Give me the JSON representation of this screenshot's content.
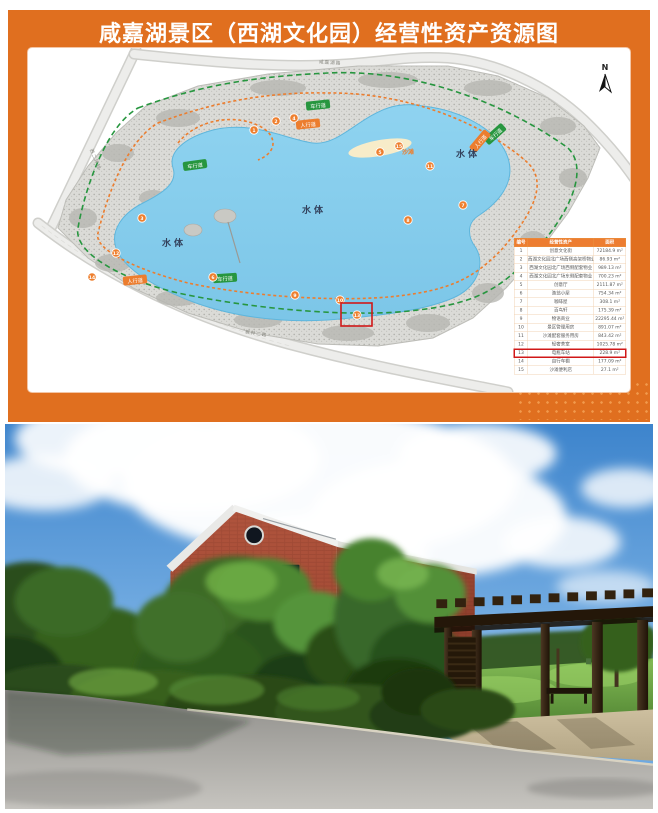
{
  "poster": {
    "title": "咸嘉湖景区（西湖文化园）经营性资产资源图",
    "map": {
      "north_label": "N",
      "water_label": "水体",
      "beach_label": "沙滩",
      "vehicle_path_label": "车行道",
      "pedestrian_path_label": "人行道",
      "roads": [
        {
          "name": "咸嘉湖路"
        },
        {
          "name": "西二环线"
        },
        {
          "name": "枫林二路"
        }
      ],
      "markers": [
        {
          "n": "1",
          "x": 226,
          "y": 82
        },
        {
          "n": "2",
          "x": 248,
          "y": 73
        },
        {
          "n": "3",
          "x": 114,
          "y": 170
        },
        {
          "n": "4",
          "x": 266,
          "y": 70
        },
        {
          "n": "5",
          "x": 352,
          "y": 104
        },
        {
          "n": "6",
          "x": 185,
          "y": 229
        },
        {
          "n": "7",
          "x": 435,
          "y": 157
        },
        {
          "n": "8",
          "x": 380,
          "y": 172
        },
        {
          "n": "9",
          "x": 267,
          "y": 247
        },
        {
          "n": "10",
          "x": 312,
          "y": 252
        },
        {
          "n": "11",
          "x": 402,
          "y": 118
        },
        {
          "n": "12",
          "x": 88,
          "y": 205
        },
        {
          "n": "13",
          "x": 329,
          "y": 267
        },
        {
          "n": "14",
          "x": 64,
          "y": 229
        },
        {
          "n": "15",
          "x": 371,
          "y": 98
        }
      ]
    },
    "table": {
      "headers": [
        "编号",
        "经营性资产",
        "面积"
      ],
      "rows": [
        [
          "1",
          "创意文化街",
          "72184.9 m²"
        ],
        [
          "2",
          "西湖文化园北广场西侧高架桥物业",
          "86.93 m²"
        ],
        [
          "3",
          "西湖文化园北广场西侧配套物业",
          "989.13 m²"
        ],
        [
          "4",
          "西湖文化园北广场东侧配套物业",
          "700.23 m²"
        ],
        [
          "5",
          "创意厅",
          "2111.87 m²"
        ],
        [
          "6",
          "渔翁小屋",
          "754.34 m²"
        ],
        [
          "7",
          "咖啡屋",
          "308.1 m²"
        ],
        [
          "8",
          "百鸟轩",
          "175.39 m²"
        ],
        [
          "9",
          "物语商业",
          "22295.44 m²"
        ],
        [
          "10",
          "景区管理用房",
          "891.07 m²"
        ],
        [
          "11",
          "沙滩配套服务用房",
          "843.42 m²"
        ],
        [
          "12",
          "轻奢茶室",
          "1025.78 m²"
        ],
        [
          "13",
          "电瓶车站",
          "228.9 m²"
        ],
        [
          "14",
          "自行车棚",
          "177.09 m²"
        ],
        [
          "15",
          "沙滩便利店",
          "27.1 m²"
        ]
      ],
      "highlight_row": 13
    }
  },
  "colors": {
    "poster_bg": "#e06f1f",
    "table_header": "#ed7d31",
    "marker_orange": "#ee7f2e",
    "vehicle_path_green": "#27963f",
    "pedestrian_path_orange": "#ec7d2e",
    "highlight_red": "#d01818",
    "lake_blue": "#84cdec",
    "sky_blue": "#4a8fd4",
    "brick_red": "#a64f38",
    "foliage_green": "#3c6b27",
    "pergola_brown": "#32220f",
    "road_gray": "#a9a7a3"
  }
}
